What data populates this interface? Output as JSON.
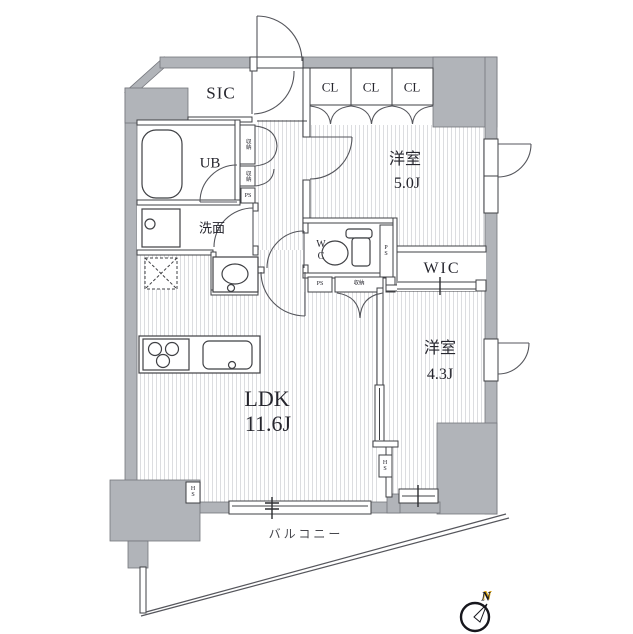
{
  "plan": {
    "rooms": {
      "sic": "SIC",
      "ub": "UB",
      "washroom": "洗面",
      "wc_line1": "W",
      "wc_line2": "C",
      "cl": [
        "CL",
        "CL",
        "CL"
      ],
      "bedroom1_name": "洋室",
      "bedroom1_size": "5.0J",
      "wic": "WIC",
      "bedroom2_name": "洋室",
      "bedroom2_size": "4.3J",
      "ldk_name": "LDK",
      "ldk_size": "11.6J",
      "balcony": "バルコニー"
    },
    "small_labels": {
      "ps_shaft": "PS",
      "ps_hall": "PS",
      "ps_corridor": "PS",
      "storage_upper": "収納",
      "storage_lower": "収納",
      "storage_wc": "収納",
      "hs_left": "HS",
      "hs_right": "HS"
    },
    "compass": {
      "north_label": "N"
    },
    "colors": {
      "wall_fill": "#b1b4b9",
      "line": "#3f4044",
      "floor_stripe": "#dcdde0",
      "text": "#26262e",
      "compass_accent": "#d9a414"
    }
  }
}
